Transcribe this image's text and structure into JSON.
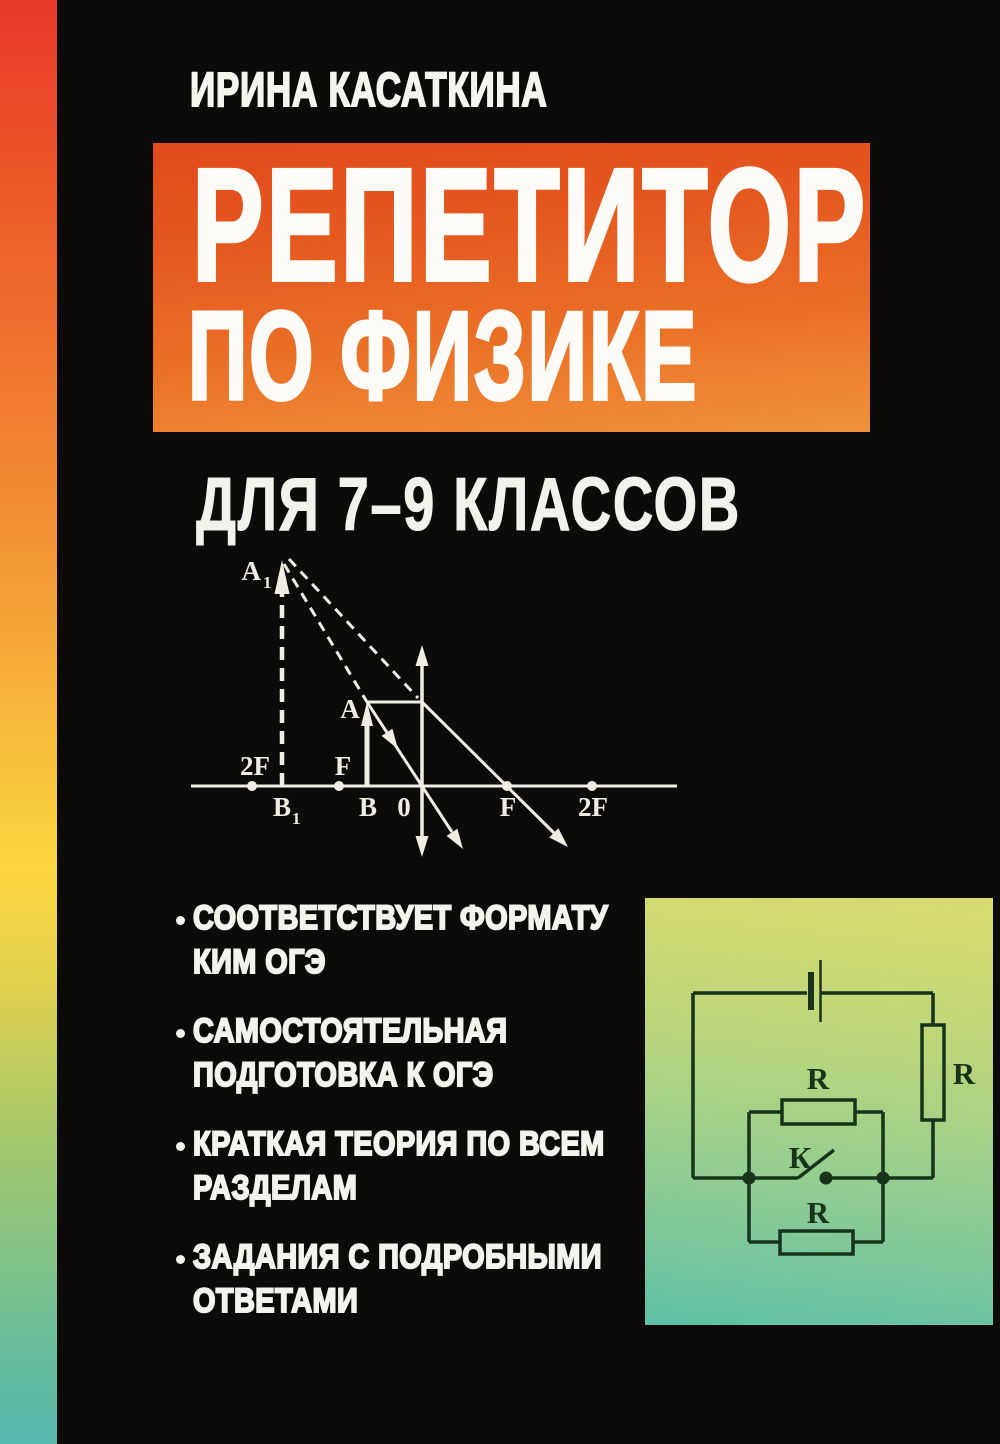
{
  "book_cover": {
    "author": "ИРИНА КАСАТКИНА",
    "title": {
      "line1": "РЕПЕТИТОР",
      "line2": "ПО ФИЗИКЕ"
    },
    "subtitle": "ДЛЯ 7–9 КЛАССОВ",
    "features": [
      {
        "line1": "СООТВЕТСТВУЕТ ФОРМАТУ",
        "line2": "КИМ ОГЭ"
      },
      {
        "line1": "САМОСТОЯТЕЛЬНАЯ",
        "line2": "ПОДГОТОВКА К ОГЭ"
      },
      {
        "line1": "КРАТКАЯ ТЕОРИЯ ПО ВСЕМ",
        "line2": "РАЗДЕЛАМ"
      },
      {
        "line1": "ЗАДАНИЯ С ПОДРОБНЫМИ",
        "line2": "ОТВЕТАМИ"
      }
    ],
    "lens_diagram": {
      "labels": {
        "image_tip": "A",
        "image_tip_sub": "1",
        "two_f_left": "2F",
        "f_left": "F",
        "object_tip": "A",
        "image_base": "B",
        "image_base_sub": "1",
        "object_base": "B",
        "lens_center": "0",
        "f_right": "F",
        "two_f_right": "2F"
      }
    },
    "circuit": {
      "labels": {
        "resistor_parallel_top": "R",
        "resistor_right": "R",
        "resistor_parallel_bottom": "R",
        "switch": "К"
      }
    },
    "colors": {
      "background": "#0d0b09",
      "title_box_orange_top": "#e04a1c",
      "title_box_orange_bottom": "#f0923a",
      "rainbow_top": "#e9392a",
      "rainbow_yellow": "#fbd53f",
      "rainbow_bottom": "#55b8ad",
      "circuit_panel_top": "#d9da6d",
      "circuit_panel_bottom": "#5fc0a6",
      "diagram_white": "#f4f2ec",
      "circuit_ink": "#17331a"
    }
  }
}
